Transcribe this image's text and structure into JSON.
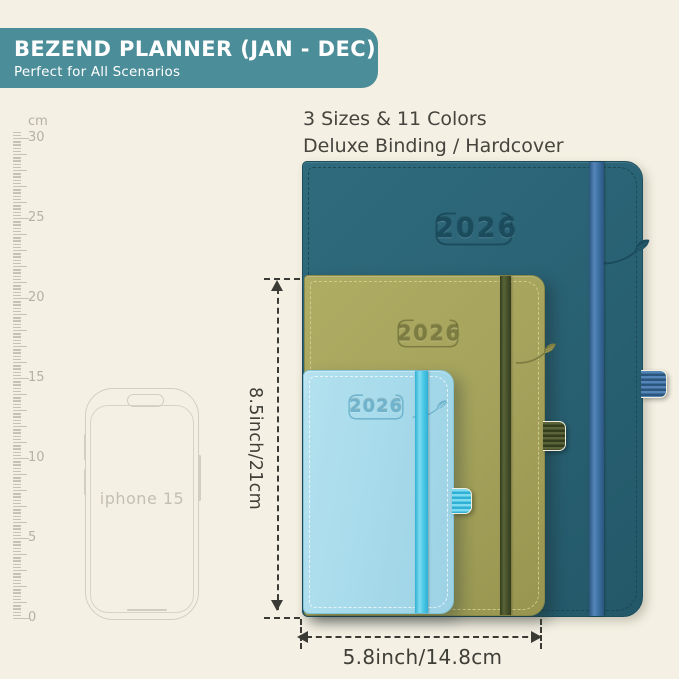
{
  "banner": {
    "title": "BEZEND PLANNER (JAN - DEC)",
    "subtitle": "Perfect for All Scenarios",
    "bg": "#4b8d98",
    "fg": "#ffffff"
  },
  "subheader": {
    "line1": "3 Sizes & 11 Colors",
    "line2": "Deluxe Binding / Hardcover"
  },
  "ruler": {
    "unit_label": "cm",
    "tick_labels": [
      "30",
      "25",
      "20",
      "15",
      "10",
      "5",
      "0"
    ]
  },
  "phone": {
    "label": "iphone 15"
  },
  "planners": [
    {
      "name": "large-teal",
      "year": "2026",
      "cover": "#2a6375",
      "edge": "#1d4e5e",
      "emboss": "#1b4c5d",
      "stitch": "#1a4553",
      "band": "#3d6fa3",
      "band_dark": "#2a567e",
      "band_light": "#5585b8"
    },
    {
      "name": "medium-olive",
      "year": "2026",
      "cover": "#a5a35c",
      "edge": "#8a8947",
      "emboss": "#7c7c41",
      "stitch": "#d6d290",
      "band": "#47502a",
      "band_dark": "#343d1d",
      "band_light": "#5a6438"
    },
    {
      "name": "small-blue",
      "year": "2026",
      "cover": "#a9dcec",
      "edge": "#82c4d9",
      "emboss": "#6fb4cc",
      "stitch": "#f0f9fc",
      "band": "#4cc8e6",
      "band_dark": "#2fb0d4",
      "band_light": "#7fdcf0"
    }
  ],
  "dimensions": {
    "height_label": "8.5inch/21cm",
    "width_label": "5.8inch/14.8cm",
    "color": "#3b3b35"
  }
}
